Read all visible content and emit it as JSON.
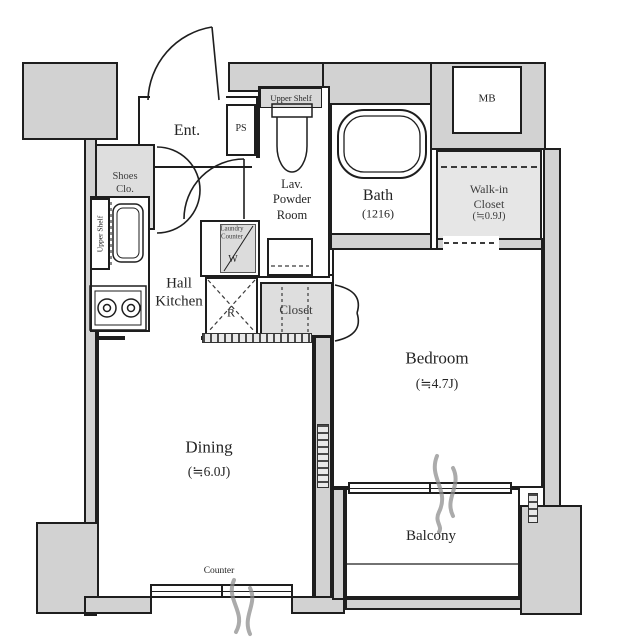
{
  "plan_title": "1DK apartment floor plan",
  "colors": {
    "wall_gray": "#d2d2d2",
    "closet_gray": "#dedede",
    "line_black": "#1e1e1e",
    "text": "#252525",
    "curtain_gray": "#8f8f8f"
  },
  "rooms": {
    "entrance": {
      "label": "Ent."
    },
    "pipe_shaft": {
      "label": "PS"
    },
    "shoes_closet": {
      "line1": "Shoes",
      "line2": "Clo."
    },
    "hall_kitchen": {
      "line1": "Hall",
      "line2": "Kitchen"
    },
    "kitchen_shelf": {
      "label": "Upper Shelf"
    },
    "laundry": {
      "line1": "Laundry",
      "line2": "Counter",
      "mark": "W"
    },
    "refrigerator": {
      "mark": "R"
    },
    "closet": {
      "label": "Closet"
    },
    "powder_room": {
      "upper_shelf": "Upper Shelf",
      "line1": "Lav.",
      "line2": "Powder",
      "line3": "Room"
    },
    "bath": {
      "name": "Bath",
      "size": "(1216)"
    },
    "meter_box": {
      "label": "MB"
    },
    "walkin_closet": {
      "line1": "Walk-in",
      "line2": "Closet",
      "size": "(≒0.9J)"
    },
    "bedroom": {
      "name": "Bedroom",
      "size": "(≒4.7J)"
    },
    "dining": {
      "name": "Dining",
      "size": "(≒6.0J)"
    },
    "balcony": {
      "name": "Balcony"
    },
    "counter": {
      "label": "Counter"
    }
  }
}
